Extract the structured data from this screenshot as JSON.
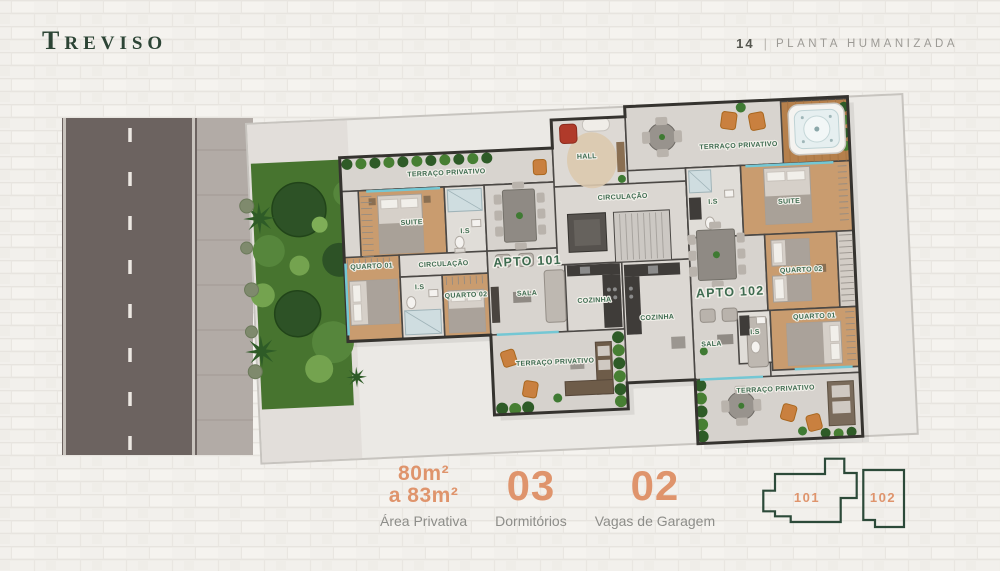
{
  "header": {
    "logo_initial": "T",
    "logo_rest": "REVISO",
    "page_number": "14",
    "separator": "|",
    "page_title": "PLANTA HUMANIZADA"
  },
  "floorplan": {
    "apt101": {
      "title": "APTO 101",
      "terrace_top": "TERRAÇO PRIVATIVO",
      "suite": "SUITE",
      "bath_suite": "I.S",
      "circulation": "CIRCULAÇÃO",
      "bedroom1": "QUARTO 01",
      "bath": "I.S",
      "bedroom2": "QUARTO 02",
      "living": "SALA",
      "kitchen": "COZINHA",
      "terrace_bottom": "TERRAÇO PRIVATIVO"
    },
    "common": {
      "hall": "HALL",
      "circulation": "CIRCULAÇÃO"
    },
    "apt102": {
      "title": "APTO 102",
      "terrace_top": "TERRAÇO PRIVATIVO",
      "bath_suite": "I.S",
      "suite": "SUITE",
      "bedroom2": "QUARTO 02",
      "kitchen": "COZINHA",
      "living": "SALA",
      "bath": "I.S",
      "bedroom1": "QUARTO 01",
      "terrace_bottom": "TERRAÇO PRIVATIVO"
    }
  },
  "stats": {
    "area": {
      "value_line1": "80m²",
      "value_line2": "a 83m²",
      "label": "Área Privativa"
    },
    "bedrooms": {
      "value": "03",
      "label": "Dormitórios"
    },
    "parking": {
      "value": "02",
      "label": "Vagas de Garagem"
    }
  },
  "keyplan": {
    "unit101": "101",
    "unit102": "102"
  },
  "colors": {
    "accent_orange": "#DF946C",
    "brand_green": "#2C4435",
    "room_label_green": "#3E6B50",
    "muted_gray": "#8D8D89"
  }
}
